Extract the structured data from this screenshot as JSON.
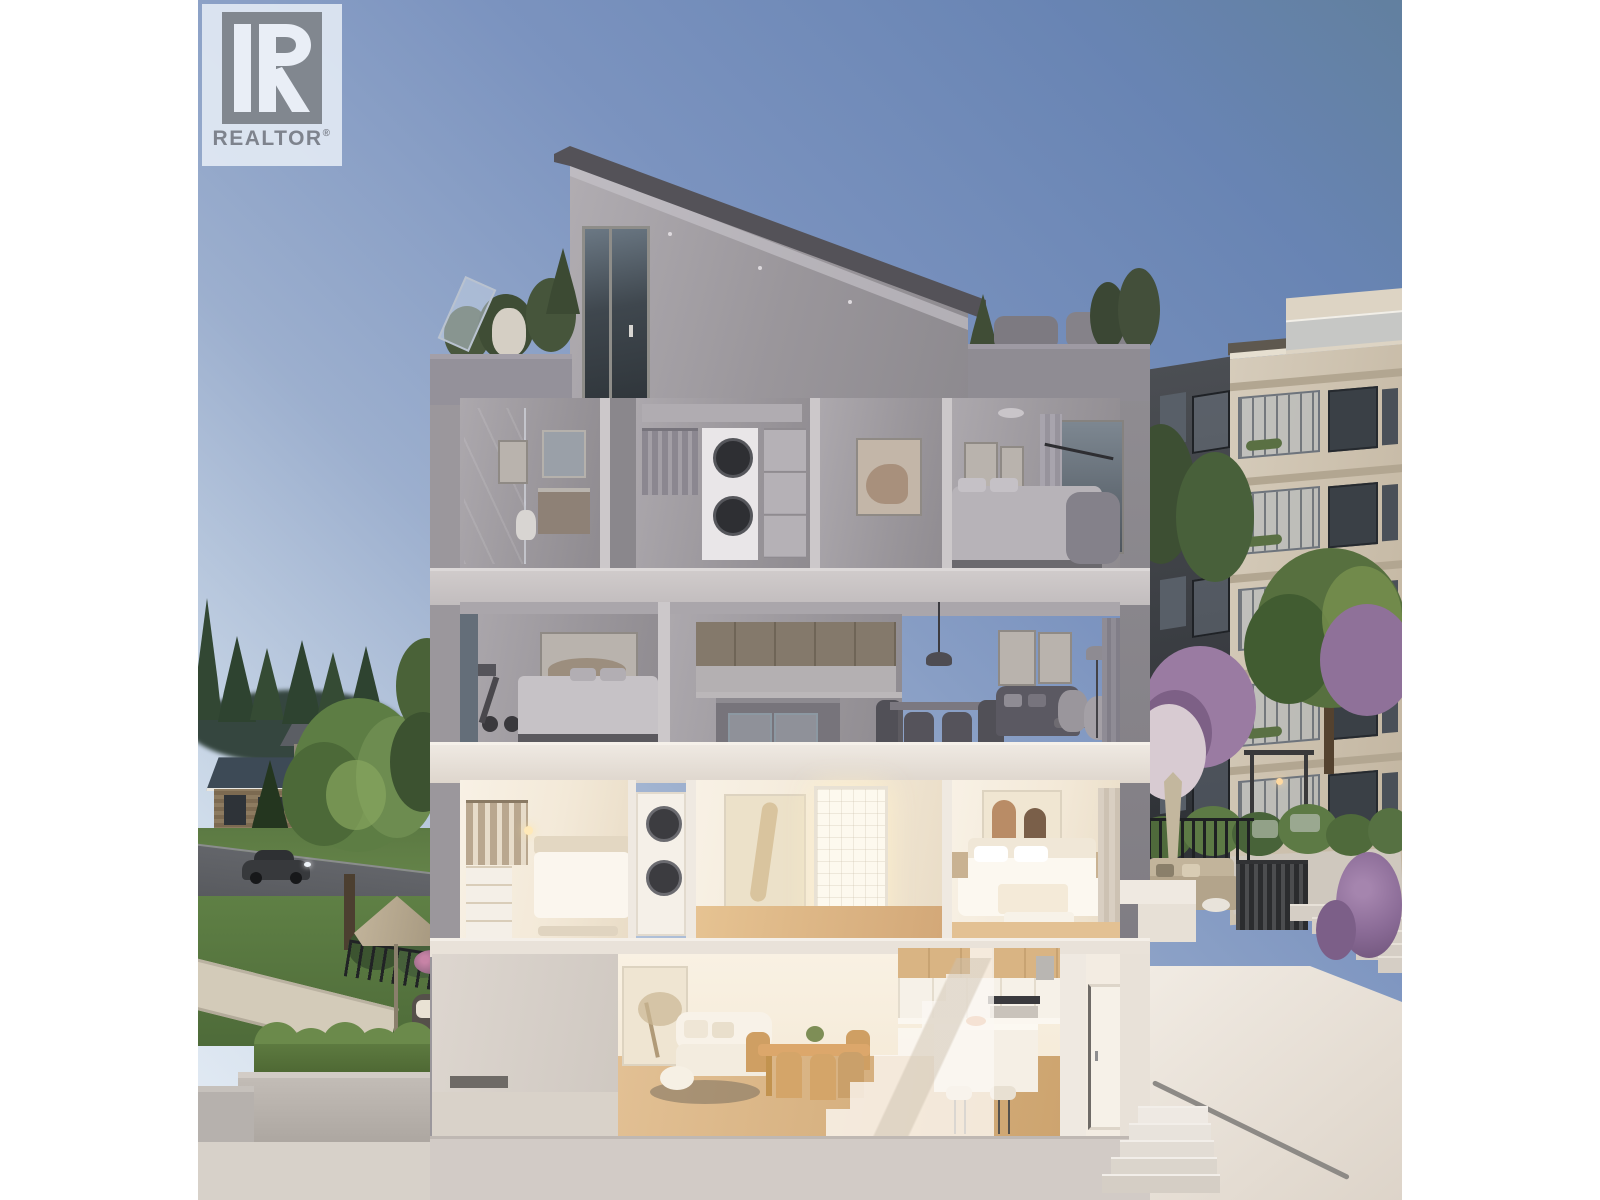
{
  "logo": {
    "brand": "REALTOR",
    "registered": "®",
    "icon": "realtor-r-monogram",
    "box_bg": "rgba(235,241,249,0.82)",
    "mark_gray": "#83899399",
    "text_gray": "#7e838d"
  },
  "scene": {
    "subject": "dusk cutaway cross-section rendering of a four-level townhouse",
    "floors": [
      {
        "name": "roof",
        "features": [
          "mono-pitch sloped roof",
          "left roof terrace with glass rail, planters and chair",
          "right roof terrace with lounge seating and small trees",
          "tall clerestory window"
        ]
      },
      {
        "name": "upper-floor",
        "rooms": [
          "bathroom with glass shower and vanity",
          "walk-in closet with stacked washer-dryer",
          "hallway with artwork",
          "bedroom with window and armchair"
        ]
      },
      {
        "name": "mid-floor",
        "rooms": [
          "bedroom with exercise bike",
          "kitchen with island",
          "dining area with pendant light",
          "living room with sofa, art and floor lamp"
        ]
      },
      {
        "name": "lower-floor",
        "rooms": [
          "walk-in closet and guest bed",
          "stacked laundry",
          "hallway with large artwork and lit bathroom door",
          "primary bedroom with white bed"
        ]
      },
      {
        "name": "ground-floor",
        "rooms": [
          "entry vestibule with rug",
          "living area with white sofa",
          "wood dining table with chairs",
          "translucent staircase",
          "kitchen with island, stools and oven",
          "entry door"
        ]
      }
    ],
    "surroundings": [
      "suburban street with dark sports car",
      "houses with dark roofs and evergreen trees",
      "large leafy tree and lawns",
      "patio with taupe umbrella and wicker chairs",
      "hedge planter boxes",
      "neighbouring condo building with glass balconies",
      "courtyard with flowering purple trees, pergola, closed umbrella and outdoor lounge",
      "dark slat gate and concrete amenity steps",
      "exterior stair with metal handrail"
    ]
  },
  "colors": {
    "page_bg": "#ffffff",
    "sky_top_right": "#6884b3",
    "sky_horizon": "#e7eef6",
    "roof_fascia": "#545258",
    "facade_gray": "#8e8b90",
    "parapet_gray": "#94919a",
    "slab_gray": "#cac5c6",
    "slab_warm": "#ece5dc",
    "interior_dusk_wall": "#a09ca1",
    "interior_warm_wall": "#f6eee2",
    "warm_glow": "#fdf5e4",
    "wood_floor": "#ddbb8e",
    "neighbor_beige": "#c9bcA6",
    "neighbor_dark": "#43464b",
    "tree_green": "#55703f",
    "blossom_purple": "#9a7ba2",
    "grass_green": "#5f8045",
    "street_gray": "#5f6163",
    "planter_hedge": "#6b8a4b",
    "umbrella_taupe": "#b5a78e",
    "stair_wall_cream": "#efe9e1"
  },
  "generate": {
    "neighbor_floors": 5,
    "neighbor_dark_floors": 5,
    "concrete_steps": 5,
    "marble_steps": 5,
    "evergreen_trees": 5,
    "courtyard_shrubs": 6,
    "hedge_mounds": 5
  }
}
